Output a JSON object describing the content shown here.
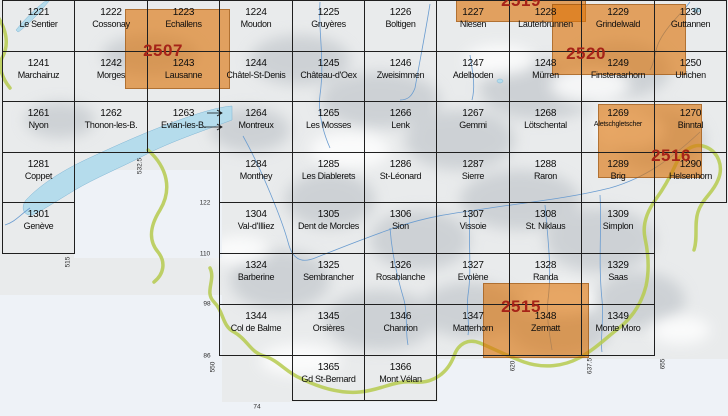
{
  "map_title": "Swiss national map 1:25000 sheet index (Lake Geneva / Valais / Bernese Alps section)",
  "colors": {
    "composite_orange": "#e9a866",
    "composite_number_red": "#a62318",
    "grid_line": "#1f1f1f",
    "lake_blue": "#b5dcec",
    "border_green": "#b6cb4f",
    "terrain_shadow": "#b7bdc3",
    "paper": "#eef2f7"
  },
  "cells": [
    {
      "n": "1221",
      "name": "Le Sentier",
      "c": 1,
      "r": 1
    },
    {
      "n": "1222",
      "name": "Cossonay",
      "c": 2,
      "r": 1
    },
    {
      "n": "1223",
      "name": "Echallens",
      "c": 3,
      "r": 1
    },
    {
      "n": "1224",
      "name": "Moudon",
      "c": 4,
      "r": 1
    },
    {
      "n": "1225",
      "name": "Gruyères",
      "c": 5,
      "r": 1
    },
    {
      "n": "1226",
      "name": "Boltigen",
      "c": 6,
      "r": 1
    },
    {
      "n": "1227",
      "name": "Niesen",
      "c": 7,
      "r": 1
    },
    {
      "n": "1228",
      "name": "Lauterbrunnen",
      "c": 8,
      "r": 1
    },
    {
      "n": "1229",
      "name": "Grindelwald",
      "c": 9,
      "r": 1
    },
    {
      "n": "1230",
      "name": "Guttannen",
      "c": 10,
      "r": 1
    },
    {
      "n": "1241",
      "name": "Marchairuz",
      "c": 1,
      "r": 2
    },
    {
      "n": "1242",
      "name": "Morges",
      "c": 2,
      "r": 2
    },
    {
      "n": "1243",
      "name": "Lausanne",
      "c": 3,
      "r": 2
    },
    {
      "n": "1244",
      "name": "Châtel-St-Denis",
      "c": 4,
      "r": 2
    },
    {
      "n": "1245",
      "name": "Château-d'Oex",
      "c": 5,
      "r": 2
    },
    {
      "n": "1246",
      "name": "Zweisimmen",
      "c": 6,
      "r": 2
    },
    {
      "n": "1247",
      "name": "Adelboden",
      "c": 7,
      "r": 2
    },
    {
      "n": "1248",
      "name": "Mürren",
      "c": 8,
      "r": 2
    },
    {
      "n": "1249",
      "name": "Finsteraarhorn",
      "c": 9,
      "r": 2
    },
    {
      "n": "1250",
      "name": "Ulrichen",
      "c": 10,
      "r": 2
    },
    {
      "n": "1261",
      "name": "Nyon",
      "c": 1,
      "r": 3
    },
    {
      "n": "1262",
      "name": "Thonon-les-B.",
      "c": 2,
      "r": 3
    },
    {
      "n": "1263",
      "name": "Evian-les-B.",
      "c": 3,
      "r": 3
    },
    {
      "n": "1264",
      "name": "Montreux",
      "c": 4,
      "r": 3
    },
    {
      "n": "1265",
      "name": "Les Mosses",
      "c": 5,
      "r": 3
    },
    {
      "n": "1266",
      "name": "Lenk",
      "c": 6,
      "r": 3
    },
    {
      "n": "1267",
      "name": "Gemmi",
      "c": 7,
      "r": 3
    },
    {
      "n": "1268",
      "name": "Lötschental",
      "c": 8,
      "r": 3
    },
    {
      "n": "1269",
      "name": "Aletschgletscher",
      "c": 9,
      "r": 3,
      "small": true
    },
    {
      "n": "1270",
      "name": "Binntal",
      "c": 10,
      "r": 3
    },
    {
      "n": "1281",
      "name": "Coppet",
      "c": 1,
      "r": 4
    },
    {
      "n": "1284",
      "name": "Monthey",
      "c": 4,
      "r": 4
    },
    {
      "n": "1285",
      "name": "Les Diablerets",
      "c": 5,
      "r": 4
    },
    {
      "n": "1286",
      "name": "St-Léonard",
      "c": 6,
      "r": 4
    },
    {
      "n": "1287",
      "name": "Sierre",
      "c": 7,
      "r": 4
    },
    {
      "n": "1288",
      "name": "Raron",
      "c": 8,
      "r": 4
    },
    {
      "n": "1289",
      "name": "Brig",
      "c": 9,
      "r": 4
    },
    {
      "n": "1290",
      "name": "Helsenhorn",
      "c": 10,
      "r": 4
    },
    {
      "n": "1301",
      "name": "Genève",
      "c": 1,
      "r": 5
    },
    {
      "n": "1304",
      "name": "Val-d'Illiez",
      "c": 4,
      "r": 5
    },
    {
      "n": "1305",
      "name": "Dent de Morcles",
      "c": 5,
      "r": 5
    },
    {
      "n": "1306",
      "name": "Sion",
      "c": 6,
      "r": 5
    },
    {
      "n": "1307",
      "name": "Vissoie",
      "c": 7,
      "r": 5
    },
    {
      "n": "1308",
      "name": "St. Niklaus",
      "c": 8,
      "r": 5
    },
    {
      "n": "1309",
      "name": "Simplon",
      "c": 9,
      "r": 5
    },
    {
      "n": "1324",
      "name": "Barberine",
      "c": 4,
      "r": 6
    },
    {
      "n": "1325",
      "name": "Sembrancher",
      "c": 5,
      "r": 6
    },
    {
      "n": "1326",
      "name": "Rosablanche",
      "c": 6,
      "r": 6
    },
    {
      "n": "1327",
      "name": "Evolène",
      "c": 7,
      "r": 6
    },
    {
      "n": "1328",
      "name": "Randa",
      "c": 8,
      "r": 6
    },
    {
      "n": "1329",
      "name": "Saas",
      "c": 9,
      "r": 6
    },
    {
      "n": "1344",
      "name": "Col de Balme",
      "c": 4,
      "r": 7
    },
    {
      "n": "1345",
      "name": "Orsières",
      "c": 5,
      "r": 7
    },
    {
      "n": "1346",
      "name": "Chanrion",
      "c": 6,
      "r": 7
    },
    {
      "n": "1347",
      "name": "Matterhorn",
      "c": 7,
      "r": 7
    },
    {
      "n": "1348",
      "name": "Zermatt",
      "c": 8,
      "r": 7
    },
    {
      "n": "1349",
      "name": "Monte Moro",
      "c": 9,
      "r": 7
    },
    {
      "n": "1365",
      "name": "Gd St-Bernard",
      "c": 5,
      "r": 8
    },
    {
      "n": "1366",
      "name": "Mont Vélan",
      "c": 6,
      "r": 8
    }
  ],
  "composites": [
    {
      "number": "2519",
      "x": 456,
      "y": -20,
      "w": 130,
      "h": 42,
      "lx": 521,
      "ly": 1
    },
    {
      "number": "2507",
      "x": 125,
      "y": 9,
      "w": 105,
      "h": 80,
      "lx": 163,
      "ly": 51
    },
    {
      "number": "2520",
      "x": 552,
      "y": 4,
      "w": 134,
      "h": 71,
      "lx": 586,
      "ly": 54
    },
    {
      "number": "2516",
      "x": 598,
      "y": 104,
      "w": 104,
      "h": 74,
      "lx": 671,
      "ly": 156
    },
    {
      "number": "2515",
      "x": 483,
      "y": 283,
      "w": 106,
      "h": 75,
      "lx": 521,
      "ly": 307
    }
  ],
  "edge_labels": [
    {
      "text": "532.5",
      "x": 140,
      "y": 166,
      "rot": true
    },
    {
      "text": "515",
      "x": 68,
      "y": 262,
      "rot": true
    },
    {
      "text": "550",
      "x": 213,
      "y": 367,
      "rot": true
    },
    {
      "text": "620",
      "x": 513,
      "y": 366,
      "rot": true
    },
    {
      "text": "637.5",
      "x": 590,
      "y": 366,
      "rot": true
    },
    {
      "text": "655",
      "x": 663,
      "y": 364,
      "rot": true
    },
    {
      "text": "122",
      "x": 205,
      "y": 203,
      "rot": false
    },
    {
      "text": "110",
      "x": 205,
      "y": 254,
      "rot": false
    },
    {
      "text": "98",
      "x": 207,
      "y": 304,
      "rot": false
    },
    {
      "text": "86",
      "x": 207,
      "y": 356,
      "rot": false
    },
    {
      "text": "74",
      "x": 257,
      "y": 407,
      "rot": false
    }
  ]
}
